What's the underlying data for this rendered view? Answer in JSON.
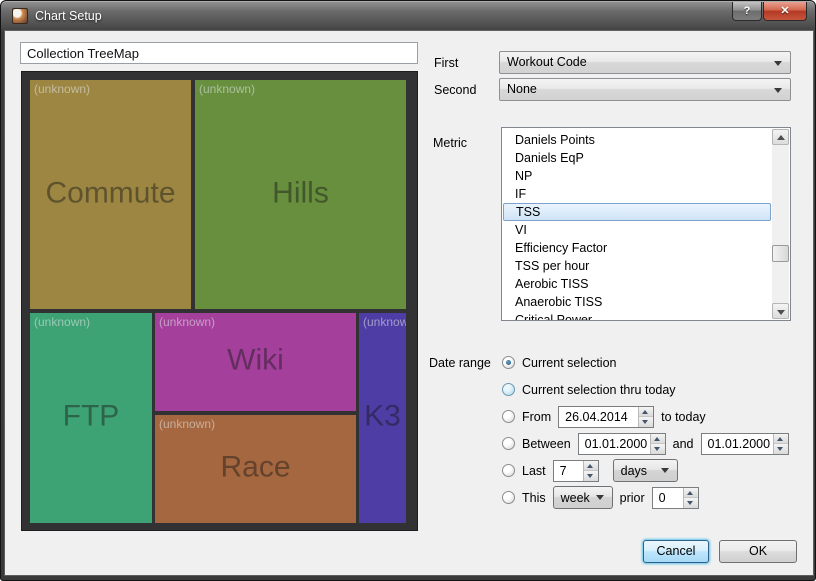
{
  "window": {
    "title": "Chart Setup",
    "help_icon": "?",
    "close_icon": "✕"
  },
  "name_input": {
    "value": "Collection TreeMap"
  },
  "treemap": {
    "tiles": [
      {
        "name": "Commute",
        "tag": "(unknown)",
        "color": "#9c8642"
      },
      {
        "name": "Hills",
        "tag": "(unknown)",
        "color": "#678f3e"
      },
      {
        "name": "FTP",
        "tag": "(unknown)",
        "color": "#3ea374"
      },
      {
        "name": "Wiki",
        "tag": "(unknown)",
        "color": "#a4409b"
      },
      {
        "name": "Race",
        "tag": "(unknown)",
        "color": "#a4673f"
      },
      {
        "name": "K3",
        "tag": "(unknown)",
        "color": "#4e3da5"
      }
    ]
  },
  "first": {
    "label": "First",
    "value": "Workout Code"
  },
  "second": {
    "label": "Second",
    "value": "None"
  },
  "metric": {
    "label": "Metric",
    "selected": "TSS",
    "items": [
      "Daniels Points",
      "Daniels EqP",
      "NP",
      "IF",
      "TSS",
      "VI",
      "Efficiency Factor",
      "TSS per hour",
      "Aerobic TISS",
      "Anaerobic TISS",
      "Critical Power"
    ]
  },
  "date_range": {
    "label": "Date range",
    "selected": "Current selection",
    "current": {
      "label": "Current selection"
    },
    "thru": {
      "label": "Current selection thru today"
    },
    "from": {
      "label": "From",
      "date": "26.04.2014",
      "suffix": "to today"
    },
    "between": {
      "label": "Between",
      "date1": "01.01.2000",
      "and": "and",
      "date2": "01.01.2000"
    },
    "last": {
      "label": "Last",
      "count": "7",
      "unit": "days"
    },
    "this": {
      "label": "This",
      "period": "week",
      "prior_label": "prior",
      "prior": "0"
    }
  },
  "buttons": {
    "cancel": "Cancel",
    "ok": "OK"
  },
  "colors": {
    "accent_selection": "#7da2ce",
    "titlebar": "#4a4a4a",
    "treemap_bg": "#323234"
  }
}
